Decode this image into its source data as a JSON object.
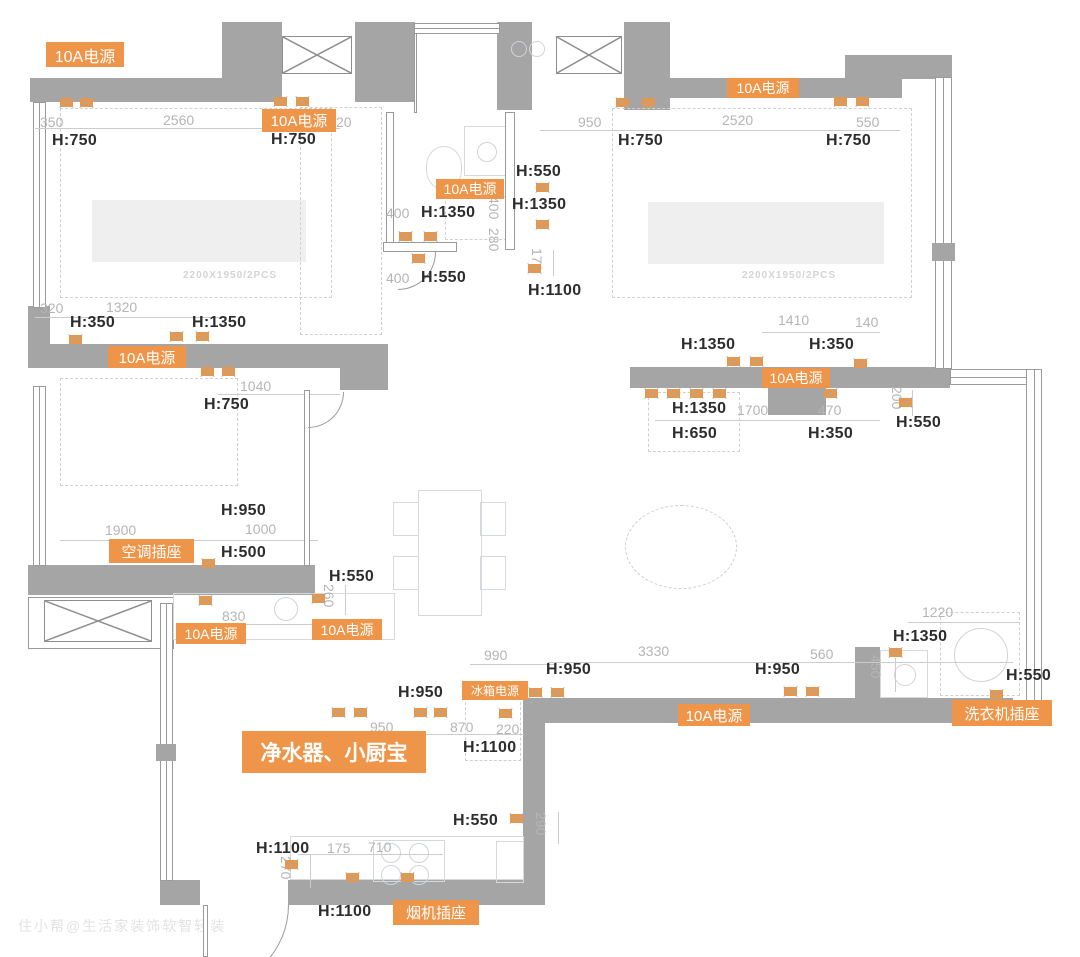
{
  "meta": {
    "watermark": "住小帮@生活家装饰软智轻装"
  },
  "palette": {
    "wall": "#a5a5a5",
    "accent": "#ef9549",
    "dim": "#b5b5b5",
    "height": "#2d2d2d"
  },
  "plan": {
    "walls": [
      [
        30,
        78,
        195,
        24
      ],
      [
        222,
        22,
        60,
        80
      ],
      [
        355,
        22,
        60,
        80
      ],
      [
        497,
        22,
        35,
        88
      ],
      [
        624,
        22,
        46,
        88
      ],
      [
        665,
        78,
        237,
        20
      ],
      [
        845,
        55,
        107,
        24
      ],
      [
        28,
        306,
        22,
        42
      ],
      [
        28,
        344,
        360,
        24
      ],
      [
        340,
        368,
        48,
        22
      ],
      [
        28,
        565,
        287,
        30
      ],
      [
        523,
        698,
        22,
        207
      ],
      [
        523,
        698,
        490,
        25
      ],
      [
        855,
        647,
        25,
        53
      ],
      [
        288,
        880,
        257,
        25
      ],
      [
        160,
        880,
        40,
        25
      ],
      [
        630,
        367,
        320,
        21
      ],
      [
        768,
        388,
        58,
        27
      ]
    ],
    "thin_walls": [
      [
        386,
        112,
        8,
        132
      ],
      [
        505,
        112,
        10,
        138
      ],
      [
        383,
        242,
        74,
        10
      ],
      [
        414,
        33,
        3,
        80
      ],
      [
        304,
        390,
        6,
        176
      ],
      [
        203,
        905,
        5,
        52
      ]
    ],
    "windows": [
      [
        33,
        102,
        13,
        206,
        "v"
      ],
      [
        33,
        386,
        13,
        180,
        "v"
      ],
      [
        160,
        603,
        13,
        278,
        "v"
      ],
      [
        414,
        23,
        86,
        11,
        "h"
      ],
      [
        935,
        77,
        17,
        292,
        "v"
      ],
      [
        950,
        369,
        90,
        16,
        "h"
      ],
      [
        1026,
        369,
        16,
        338,
        "v"
      ]
    ],
    "window_blocks": [
      [
        156,
        744,
        20,
        17
      ],
      [
        932,
        243,
        23,
        18
      ]
    ],
    "flue_frames": [
      [
        28,
        597,
        146,
        52
      ]
    ],
    "flue_boxes": [
      [
        282,
        36,
        70,
        38
      ],
      [
        556,
        36,
        66,
        38
      ],
      [
        44,
        600,
        108,
        42
      ]
    ],
    "door_arcs": [
      [
        205,
        905,
        84,
        84
      ],
      [
        398,
        252,
        38,
        38
      ],
      [
        308,
        392,
        36,
        36
      ]
    ],
    "power_labels": [
      {
        "text": "10A电源",
        "x": 46,
        "y": 42,
        "w": 78,
        "h": 25,
        "fs": 16
      },
      {
        "text": "10A电源",
        "x": 262,
        "y": 109,
        "w": 74,
        "h": 23,
        "fs": 15
      },
      {
        "text": "10A电源",
        "x": 436,
        "y": 179,
        "w": 68,
        "h": 20,
        "fs": 14
      },
      {
        "text": "10A电源",
        "x": 727,
        "y": 78,
        "w": 72,
        "h": 20,
        "fs": 14
      },
      {
        "text": "10A电源",
        "x": 108,
        "y": 346,
        "w": 78,
        "h": 22,
        "fs": 15
      },
      {
        "text": "10A电源",
        "x": 762,
        "y": 368,
        "w": 68,
        "h": 20,
        "fs": 14
      },
      {
        "text": "空调插座",
        "x": 109,
        "y": 539,
        "w": 85,
        "h": 24,
        "fs": 15
      },
      {
        "text": "10A电源",
        "x": 176,
        "y": 623,
        "w": 70,
        "h": 21,
        "fs": 14
      },
      {
        "text": "10A电源",
        "x": 312,
        "y": 619,
        "w": 70,
        "h": 21,
        "fs": 14
      },
      {
        "text": "冰箱电源",
        "x": 462,
        "y": 681,
        "w": 66,
        "h": 19,
        "fs": 12
      },
      {
        "text": "净水器、小厨宝",
        "x": 242,
        "y": 731,
        "w": 184,
        "h": 42,
        "fs": 21,
        "bold": 1
      },
      {
        "text": "10A电源",
        "x": 678,
        "y": 704,
        "w": 72,
        "h": 22,
        "fs": 15
      },
      {
        "text": "洗衣机插座",
        "x": 952,
        "y": 700,
        "w": 100,
        "h": 26,
        "fs": 15
      },
      {
        "text": "烟机插座",
        "x": 393,
        "y": 900,
        "w": 86,
        "h": 25,
        "fs": 15
      }
    ],
    "height_labels": [
      {
        "text": "H:750",
        "x": 52,
        "y": 132
      },
      {
        "text": "H:750",
        "x": 271,
        "y": 131
      },
      {
        "text": "H:550",
        "x": 516,
        "y": 163
      },
      {
        "text": "H:1350",
        "x": 512,
        "y": 196
      },
      {
        "text": "H:1350",
        "x": 421,
        "y": 204
      },
      {
        "text": "H:550",
        "x": 421,
        "y": 269
      },
      {
        "text": "H:1100",
        "x": 528,
        "y": 282
      },
      {
        "text": "H:750",
        "x": 618,
        "y": 132
      },
      {
        "text": "H:750",
        "x": 826,
        "y": 132
      },
      {
        "text": "H:350",
        "x": 70,
        "y": 314
      },
      {
        "text": "H:1350",
        "x": 192,
        "y": 314
      },
      {
        "text": "H:750",
        "x": 204,
        "y": 396
      },
      {
        "text": "H:950",
        "x": 221,
        "y": 502
      },
      {
        "text": "H:500",
        "x": 221,
        "y": 544
      },
      {
        "text": "H:550",
        "x": 329,
        "y": 568
      },
      {
        "text": "H:1350",
        "x": 681,
        "y": 336
      },
      {
        "text": "H:350",
        "x": 809,
        "y": 336
      },
      {
        "text": "H:1350",
        "x": 672,
        "y": 400
      },
      {
        "text": "H:650",
        "x": 672,
        "y": 425
      },
      {
        "text": "H:350",
        "x": 808,
        "y": 425
      },
      {
        "text": "H:550",
        "x": 896,
        "y": 414
      },
      {
        "text": "H:950",
        "x": 398,
        "y": 684
      },
      {
        "text": "H:1100",
        "x": 463,
        "y": 739
      },
      {
        "text": "H:950",
        "x": 546,
        "y": 661
      },
      {
        "text": "H:950",
        "x": 755,
        "y": 661
      },
      {
        "text": "H:1350",
        "x": 893,
        "y": 628
      },
      {
        "text": "H:550",
        "x": 1006,
        "y": 667
      },
      {
        "text": "H:550",
        "x": 453,
        "y": 812
      },
      {
        "text": "H:1100",
        "x": 256,
        "y": 840
      },
      {
        "text": "H:1100",
        "x": 318,
        "y": 903
      }
    ],
    "dim_labels": [
      {
        "t": "350",
        "x": 40,
        "y": 114
      },
      {
        "t": "2560",
        "x": 163,
        "y": 112
      },
      {
        "t": "20",
        "x": 336,
        "y": 114
      },
      {
        "t": "950",
        "x": 578,
        "y": 114
      },
      {
        "t": "2520",
        "x": 722,
        "y": 112
      },
      {
        "t": "550",
        "x": 856,
        "y": 114
      },
      {
        "t": "400",
        "x": 386,
        "y": 205
      },
      {
        "t": "400",
        "x": 386,
        "y": 270
      },
      {
        "t": "400",
        "x": 502,
        "y": 196,
        "rot": 1
      },
      {
        "t": "280",
        "x": 502,
        "y": 228,
        "rot": 1
      },
      {
        "t": "170",
        "x": 545,
        "y": 248,
        "rot": 1
      },
      {
        "t": "320",
        "x": 40,
        "y": 300
      },
      {
        "t": "1320",
        "x": 106,
        "y": 299
      },
      {
        "t": "1040",
        "x": 240,
        "y": 378
      },
      {
        "t": "1900",
        "x": 105,
        "y": 522
      },
      {
        "t": "1000",
        "x": 245,
        "y": 521
      },
      {
        "t": "830",
        "x": 222,
        "y": 608
      },
      {
        "t": "260",
        "x": 337,
        "y": 584,
        "rot": 1
      },
      {
        "t": "1410",
        "x": 778,
        "y": 312
      },
      {
        "t": "140",
        "x": 855,
        "y": 314
      },
      {
        "t": "1700",
        "x": 737,
        "y": 402
      },
      {
        "t": "470",
        "x": 818,
        "y": 402
      },
      {
        "t": "200",
        "x": 905,
        "y": 386,
        "rot": 1
      },
      {
        "t": "990",
        "x": 484,
        "y": 647
      },
      {
        "t": "3330",
        "x": 638,
        "y": 643
      },
      {
        "t": "560",
        "x": 810,
        "y": 646
      },
      {
        "t": "950",
        "x": 370,
        "y": 719
      },
      {
        "t": "870",
        "x": 450,
        "y": 719
      },
      {
        "t": "220",
        "x": 496,
        "y": 721
      },
      {
        "t": "1220",
        "x": 922,
        "y": 604
      },
      {
        "t": "450",
        "x": 884,
        "y": 655,
        "rot": 1
      },
      {
        "t": "290",
        "x": 549,
        "y": 812,
        "rot": 1
      },
      {
        "t": "175",
        "x": 327,
        "y": 840
      },
      {
        "t": "710",
        "x": 368,
        "y": 839
      },
      {
        "t": "270",
        "x": 294,
        "y": 856,
        "rot": 1
      }
    ],
    "dim_lines": [
      [
        35,
        128,
        305,
        "h"
      ],
      [
        540,
        130,
        360,
        "h"
      ],
      [
        35,
        317,
        192,
        "h"
      ],
      [
        218,
        394,
        122,
        "h"
      ],
      [
        60,
        540,
        258,
        "h"
      ],
      [
        195,
        624,
        123,
        "h"
      ],
      [
        762,
        332,
        118,
        "h"
      ],
      [
        655,
        420,
        225,
        "h"
      ],
      [
        470,
        664,
        85,
        "h"
      ],
      [
        318,
        734,
        206,
        "h"
      ],
      [
        548,
        662,
        465,
        "h"
      ],
      [
        908,
        622,
        112,
        "h"
      ],
      [
        298,
        854,
        145,
        "h"
      ],
      [
        508,
        190,
        58,
        "v"
      ],
      [
        553,
        250,
        26,
        "v"
      ],
      [
        345,
        585,
        30,
        "v"
      ],
      [
        912,
        390,
        26,
        "v"
      ],
      [
        895,
        658,
        34,
        "v"
      ],
      [
        558,
        812,
        32,
        "v"
      ],
      [
        310,
        855,
        33,
        "v"
      ]
    ],
    "sockets": [
      [
        66,
        102
      ],
      [
        86,
        102
      ],
      [
        280,
        101
      ],
      [
        302,
        101
      ],
      [
        622,
        102
      ],
      [
        648,
        102
      ],
      [
        840,
        101
      ],
      [
        862,
        101
      ],
      [
        405,
        236
      ],
      [
        430,
        236
      ],
      [
        418,
        258
      ],
      [
        542,
        187
      ],
      [
        542,
        224
      ],
      [
        534,
        268
      ],
      [
        75,
        339
      ],
      [
        176,
        336
      ],
      [
        202,
        336
      ],
      [
        207,
        371
      ],
      [
        228,
        371
      ],
      [
        208,
        563
      ],
      [
        205,
        600
      ],
      [
        318,
        598
      ],
      [
        733,
        361
      ],
      [
        756,
        361
      ],
      [
        860,
        363
      ],
      [
        651,
        393
      ],
      [
        673,
        393
      ],
      [
        696,
        393
      ],
      [
        719,
        393
      ],
      [
        830,
        393
      ],
      [
        905,
        402
      ],
      [
        535,
        692
      ],
      [
        557,
        692
      ],
      [
        790,
        691
      ],
      [
        812,
        691
      ],
      [
        338,
        712
      ],
      [
        360,
        712
      ],
      [
        420,
        712
      ],
      [
        440,
        712
      ],
      [
        505,
        713
      ],
      [
        895,
        652
      ],
      [
        996,
        694
      ],
      [
        291,
        864
      ],
      [
        352,
        877
      ],
      [
        407,
        877
      ],
      [
        516,
        818
      ]
    ],
    "furniture": [
      {
        "type": "dash",
        "x": 60,
        "y": 108,
        "w": 272,
        "h": 190
      },
      {
        "type": "fill",
        "x": 92,
        "y": 200,
        "w": 214,
        "h": 62
      },
      {
        "type": "dash",
        "x": 612,
        "y": 108,
        "w": 300,
        "h": 190
      },
      {
        "type": "fill",
        "x": 648,
        "y": 202,
        "w": 236,
        "h": 62
      },
      {
        "type": "dash",
        "x": 60,
        "y": 378,
        "w": 178,
        "h": 108
      },
      {
        "type": "dash",
        "x": 300,
        "y": 107,
        "w": 82,
        "h": 228
      },
      {
        "type": "box",
        "x": 418,
        "y": 490,
        "w": 64,
        "h": 126
      },
      {
        "type": "box",
        "x": 393,
        "y": 502,
        "w": 26,
        "h": 34
      },
      {
        "type": "box",
        "x": 393,
        "y": 556,
        "w": 26,
        "h": 34
      },
      {
        "type": "box",
        "x": 480,
        "y": 502,
        "w": 26,
        "h": 34
      },
      {
        "type": "box",
        "x": 480,
        "y": 556,
        "w": 26,
        "h": 34
      },
      {
        "type": "ellipse",
        "x": 625,
        "y": 505,
        "w": 112,
        "h": 84
      },
      {
        "type": "dash",
        "x": 648,
        "y": 392,
        "w": 92,
        "h": 60
      },
      {
        "type": "box",
        "x": 173,
        "y": 593,
        "w": 222,
        "h": 47
      },
      {
        "type": "box",
        "x": 290,
        "y": 836,
        "w": 234,
        "h": 44
      },
      {
        "type": "box",
        "x": 373,
        "y": 840,
        "w": 72,
        "h": 42
      },
      {
        "type": "dash",
        "x": 465,
        "y": 697,
        "w": 56,
        "h": 64
      },
      {
        "type": "box",
        "x": 496,
        "y": 841,
        "w": 28,
        "h": 42
      },
      {
        "type": "dash",
        "x": 940,
        "y": 612,
        "w": 80,
        "h": 84
      },
      {
        "type": "box",
        "x": 880,
        "y": 650,
        "w": 48,
        "h": 48
      },
      {
        "type": "oval",
        "x": 426,
        "y": 146,
        "w": 36,
        "h": 44
      },
      {
        "type": "box",
        "x": 464,
        "y": 126,
        "w": 44,
        "h": 50
      },
      {
        "type": "dash",
        "x": 445,
        "y": 196,
        "w": 62,
        "h": 44
      }
    ],
    "circles": [
      [
        285,
        608,
        11
      ],
      [
        486,
        151,
        9
      ],
      [
        518,
        48,
        7
      ],
      [
        536,
        48,
        7
      ],
      [
        390,
        852,
        9
      ],
      [
        418,
        852,
        9
      ],
      [
        390,
        874,
        9
      ],
      [
        418,
        874,
        9
      ],
      [
        904,
        674,
        10
      ],
      [
        980,
        654,
        26
      ]
    ],
    "bed_labels": [
      {
        "text": "2200X1950/2PCS",
        "x": 183,
        "y": 270
      },
      {
        "text": "2200X1950/2PCS",
        "x": 742,
        "y": 270
      }
    ]
  }
}
